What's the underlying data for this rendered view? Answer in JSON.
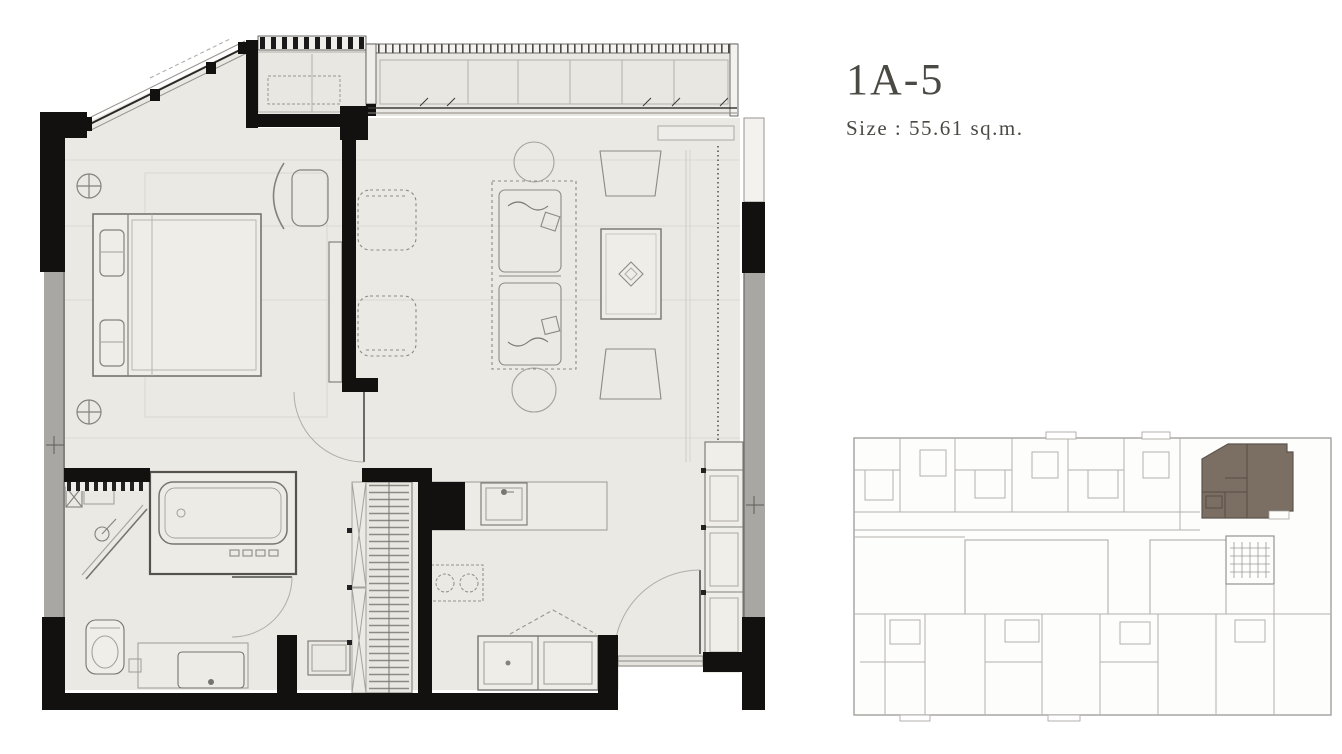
{
  "header": {
    "unit_name": "1A-5",
    "size_label": "Size : 55.61 sq.m."
  },
  "colors": {
    "wall_black": "#121110",
    "floor_fill": "#ebe9e4",
    "balcony_fill": "#e9e7e2",
    "window_gray": "#a9a7a3",
    "drawing_line": "#85827d",
    "faint_line": "#dcd9d4",
    "keyplan_line": "#b3b1ad",
    "highlight_brown": "#7b6f64",
    "title_text": "#4a4944"
  },
  "floorplan": {
    "rooms": [
      "bedroom",
      "living-dining",
      "kitchen",
      "bathroom",
      "balcony",
      "ac-ledge",
      "wardrobe",
      "entry-foyer"
    ],
    "furniture": [
      "double-bed",
      "wall-lamp",
      "bedroom-chair",
      "tv-console",
      "lounge-armchair",
      "sofa",
      "round-side-table",
      "dining-table",
      "dining-chair",
      "kitchen-sink",
      "cooktop",
      "kitchen-island",
      "bathtub",
      "shower",
      "toilet",
      "vanity-sink",
      "washer",
      "entry-closet"
    ],
    "features": [
      "diagonal-window",
      "balcony-railing",
      "sliding-door",
      "window-strip",
      "door-swing",
      "entry-threshold"
    ]
  },
  "key_plan": {
    "highlighted_unit": "1A-5",
    "highlight_color": "#7b6f64"
  }
}
